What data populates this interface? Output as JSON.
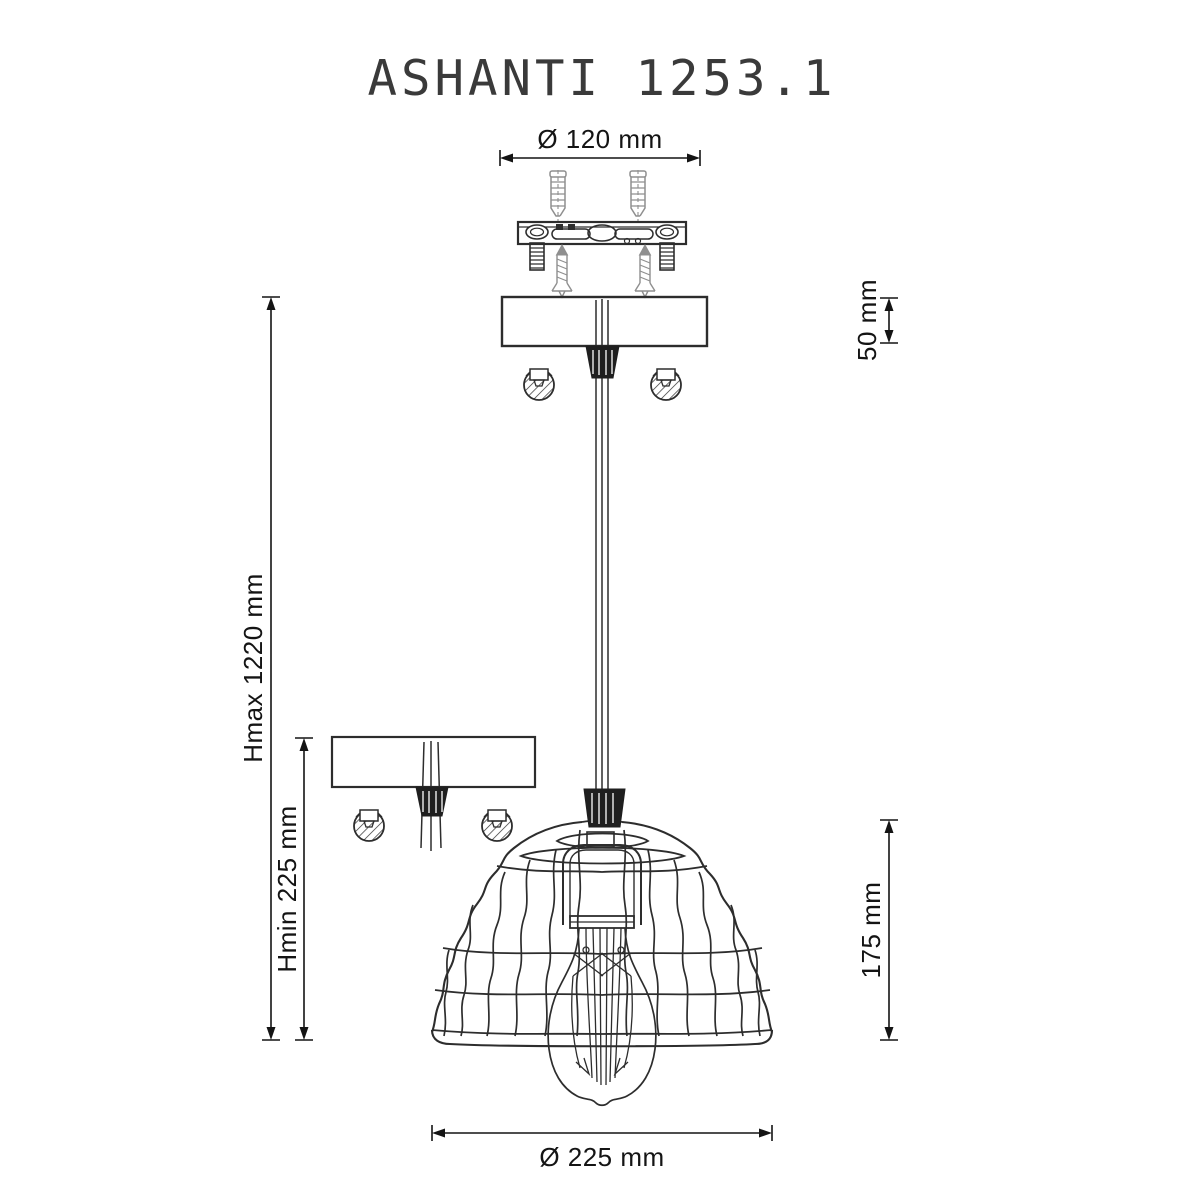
{
  "title": "ASHANTI 1253.1",
  "dimensions": {
    "canopy_diameter": "Ø 120 mm",
    "canopy_height": "50 mm",
    "max_height": "Hmax 1220 mm",
    "min_height": "Hmin 225 mm",
    "shade_height": "175 mm",
    "shade_diameter": "Ø 225 mm"
  },
  "colors": {
    "line": "#2d2d2d",
    "hardware": "#8f8f8f",
    "text": "#141414",
    "background": "#ffffff"
  }
}
